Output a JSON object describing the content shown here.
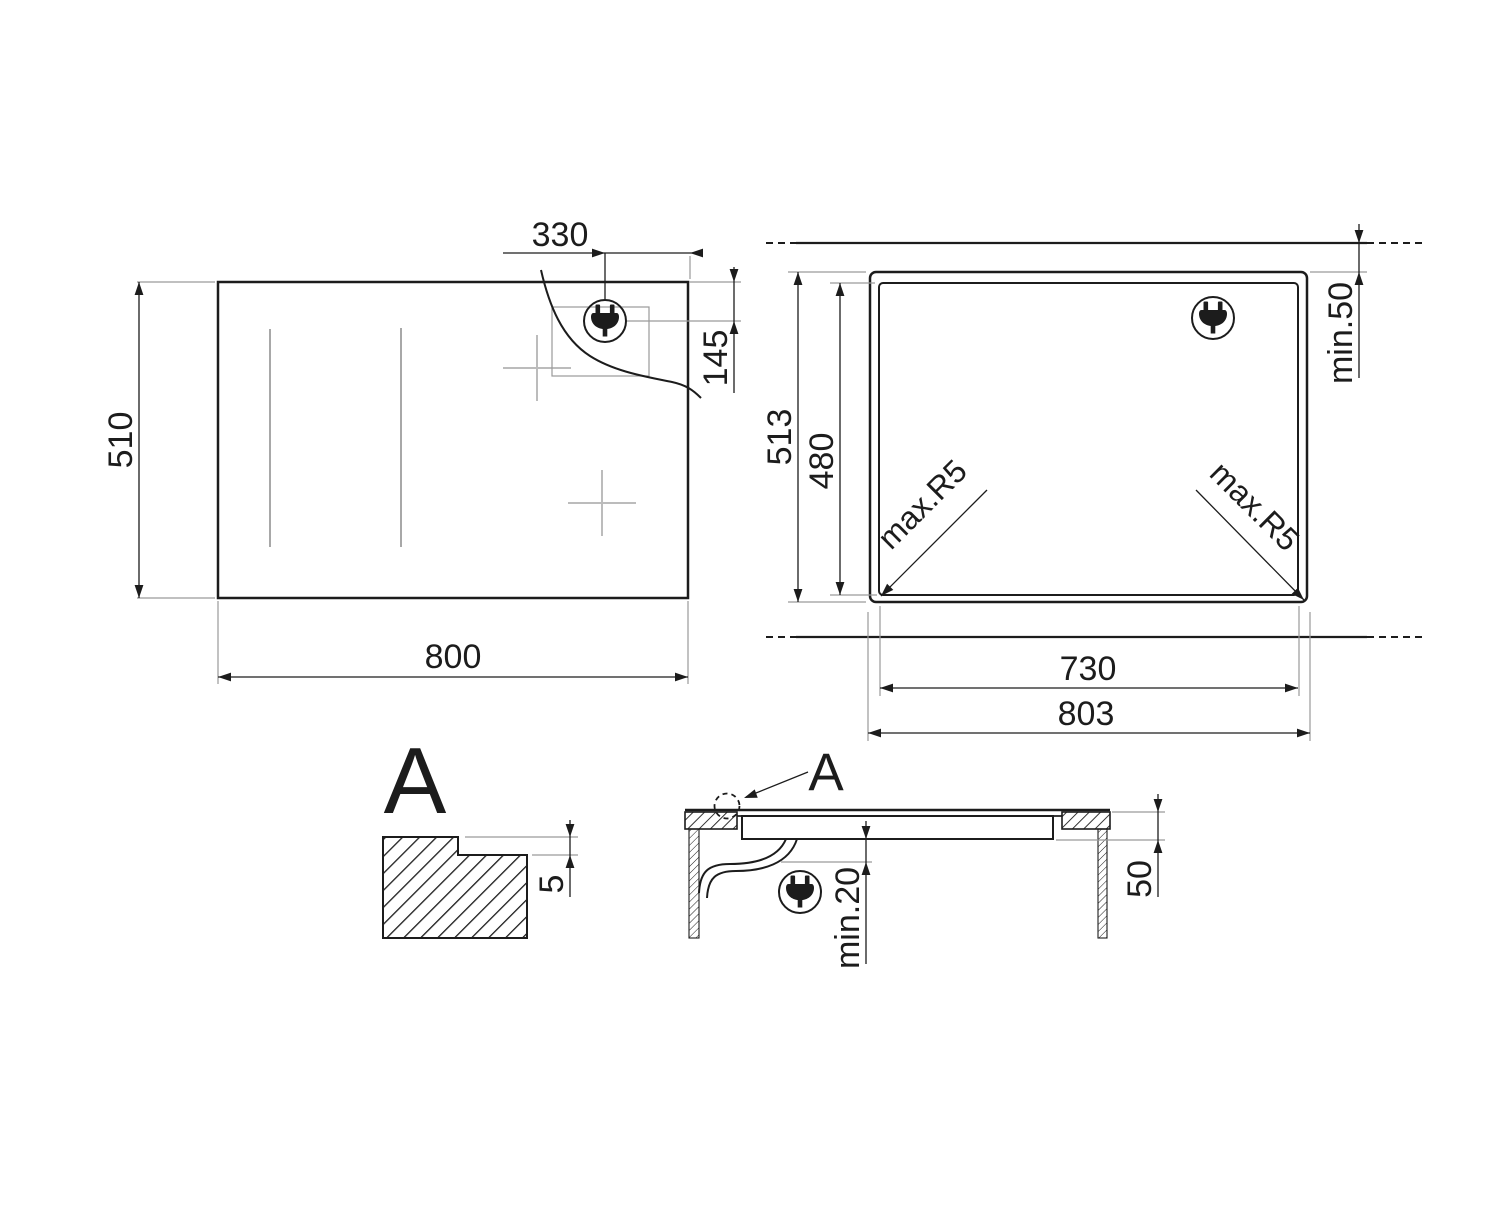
{
  "colors": {
    "line": "#1c1c1c",
    "ext": "#9a9a9a",
    "mark": "#bcbcbc",
    "zone": "#6f6f6f",
    "bg": "#ffffff"
  },
  "top_view": {
    "width": "800",
    "height": "510",
    "plug_offset": "330",
    "plug_drop": "145"
  },
  "cutout_view": {
    "outer_width": "803",
    "cutout_width": "730",
    "outer_height": "513",
    "cutout_height": "480",
    "rear_clearance": "min.50",
    "corner_radius_left": "max.R5",
    "corner_radius_right": "max.R5"
  },
  "detail_view": {
    "label": "A",
    "step_depth": "5"
  },
  "section_view": {
    "detail_ref": "A",
    "below_clearance": "min.20",
    "recess_depth": "50"
  },
  "icons": {
    "plug_icon": "power-plug"
  }
}
